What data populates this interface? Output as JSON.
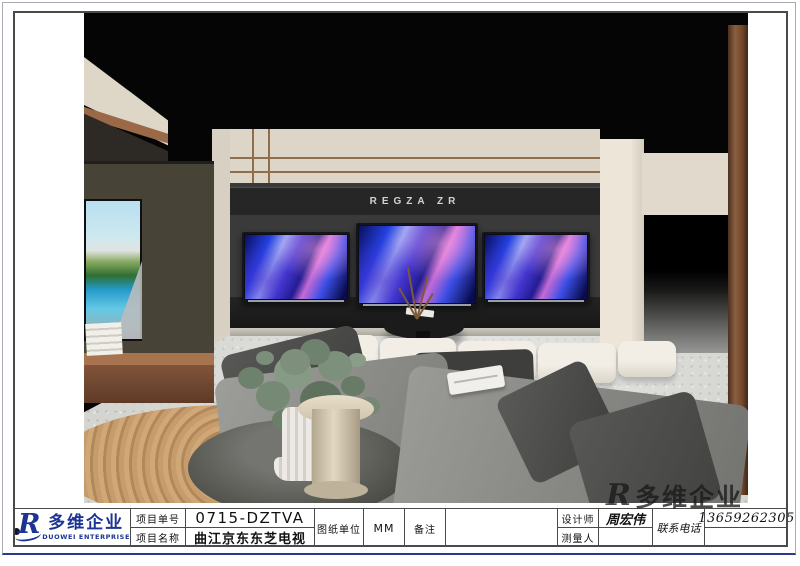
{
  "page": {
    "accent_blue": "#2b3990",
    "frame_color": "#4a4a4a"
  },
  "logo": {
    "emblem_letter": "R",
    "cn": "多维企业",
    "en": "DUOWEI ENTERPRISE",
    "color": "#1c3493"
  },
  "titleblock": {
    "project_no": {
      "label": "项目单号",
      "value": "0715-DZTVA"
    },
    "project_name": {
      "label": "项目名称",
      "value": "曲江京东东芝电视"
    },
    "drawing_unit": {
      "label": "图纸单位",
      "value": "MM"
    },
    "remark": {
      "label": "备注",
      "value": ""
    },
    "designer": {
      "label": "设计师",
      "value": "周宏伟"
    },
    "surveyor": {
      "label": "测量人",
      "value": ""
    },
    "phone": {
      "label": "联系电话",
      "value": "13659262305"
    }
  },
  "render": {
    "sign_text": "REGZA ZR",
    "tv_count": 3,
    "screen_theme_colors": [
      "#2440e0",
      "#97a6f5",
      "#d878d8",
      "#080c4e"
    ]
  },
  "watermark": {
    "emblem_letter": "R",
    "text": "多维企业"
  }
}
